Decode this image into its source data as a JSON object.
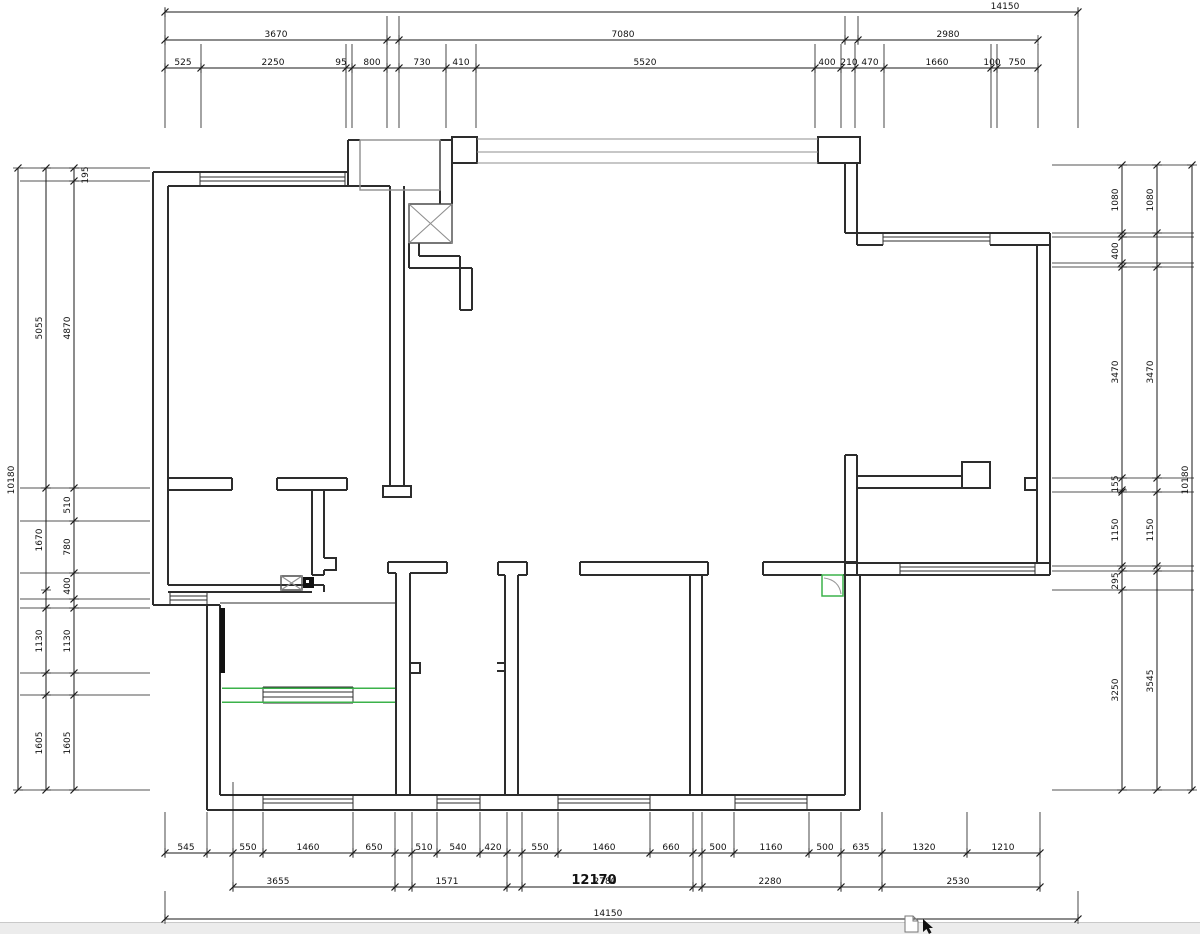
{
  "page": {
    "background": "#ffffff",
    "kind": "cad-floor-plan"
  },
  "colors": {
    "wall": "#2d2d2d",
    "dim_line": "#1a1a1a",
    "text": "#111111",
    "gray": "#8f8f8f",
    "green": "#3bb24a",
    "statusbar_bg": "#ececec"
  },
  "dim_rows": [
    {
      "name": "top-overall",
      "y": 12,
      "x1": 165,
      "x2": 1078,
      "ticks": [
        165,
        1078
      ],
      "labels": [
        {
          "t": "14150",
          "x": 1005
        }
      ]
    },
    {
      "name": "top-groups",
      "y": 40,
      "x1": 165,
      "x2": 1038,
      "ticks": [
        165,
        387,
        399,
        845,
        858,
        1038
      ],
      "labels": [
        {
          "t": "3670",
          "x": 276
        },
        {
          "t": "7080",
          "x": 623
        },
        {
          "t": "2980",
          "x": 948
        }
      ]
    },
    {
      "name": "top-detail",
      "y": 68,
      "x1": 165,
      "x2": 1038,
      "ticks": [
        165,
        201,
        346,
        352,
        387,
        399,
        446,
        476,
        815,
        841,
        855,
        884,
        991,
        997,
        1038
      ],
      "labels": [
        {
          "t": "525",
          "x": 183
        },
        {
          "t": "2250",
          "x": 273
        },
        {
          "t": "95",
          "x": 341
        },
        {
          "t": "800",
          "x": 372
        },
        {
          "t": "730",
          "x": 422
        },
        {
          "t": "410",
          "x": 461
        },
        {
          "t": "5520",
          "x": 645
        },
        {
          "t": "400",
          "x": 827
        },
        {
          "t": "210",
          "x": 849
        },
        {
          "t": "470",
          "x": 870
        },
        {
          "t": "1660",
          "x": 937
        },
        {
          "t": "100",
          "x": 992
        },
        {
          "t": "750",
          "x": 1017
        }
      ]
    },
    {
      "name": "bottom-detail",
      "y": 853,
      "x1": 165,
      "x2": 1040,
      "ticks": [
        165,
        207,
        233,
        263,
        353,
        395,
        412,
        437,
        480,
        507,
        522,
        558,
        650,
        693,
        702,
        734,
        809,
        841,
        882,
        967,
        1040
      ],
      "labels": [
        {
          "t": "545",
          "x": 186
        },
        {
          "t": "550",
          "x": 248
        },
        {
          "t": "1460",
          "x": 308
        },
        {
          "t": "650",
          "x": 374
        },
        {
          "t": "510",
          "x": 424
        },
        {
          "t": "540",
          "x": 458
        },
        {
          "t": "420",
          "x": 493
        },
        {
          "t": "550",
          "x": 540
        },
        {
          "t": "1460",
          "x": 604
        },
        {
          "t": "660",
          "x": 671
        },
        {
          "t": "500",
          "x": 718
        },
        {
          "t": "1160",
          "x": 771
        },
        {
          "t": "500",
          "x": 825
        },
        {
          "t": "635",
          "x": 861
        },
        {
          "t": "1320",
          "x": 924
        },
        {
          "t": "1210",
          "x": 1003
        }
      ]
    },
    {
      "name": "bottom-groups",
      "y": 887,
      "x1": 233,
      "x2": 1040,
      "ticks": [
        233,
        395,
        412,
        507,
        522,
        693,
        702,
        841,
        882,
        1040
      ],
      "labels": [
        {
          "t": "3655",
          "x": 278
        },
        {
          "t": "1571",
          "x": 447
        },
        {
          "t": "2780",
          "x": 605
        },
        {
          "t": "2280",
          "x": 770
        },
        {
          "t": "2530",
          "x": 958
        }
      ]
    },
    {
      "name": "bottom-overall",
      "y": 919,
      "x1": 165,
      "x2": 1078,
      "ticks": [
        165,
        1078
      ],
      "labels": [
        {
          "t": "14150",
          "x": 608
        }
      ]
    }
  ],
  "dim_cols": [
    {
      "name": "left-outer",
      "x": 18,
      "y1": 168,
      "y2": 790,
      "ticks": [
        168,
        790
      ],
      "labels": [
        {
          "t": "10180",
          "y": 480
        }
      ]
    },
    {
      "name": "left-mid",
      "x": 46,
      "y1": 168,
      "y2": 790,
      "ticks": [
        168,
        488,
        590,
        608,
        673,
        695,
        790
      ],
      "labels": [
        {
          "t": "5055",
          "y": 328
        },
        {
          "t": "1670",
          "y": 540
        },
        {
          "t": "1130",
          "y": 641
        },
        {
          "t": "1605",
          "y": 743
        }
      ]
    },
    {
      "name": "left-inner",
      "x": 74,
      "y1": 168,
      "y2": 790,
      "ticks": [
        168,
        181,
        488,
        521,
        573,
        599,
        608,
        673,
        695,
        790
      ],
      "labels": [
        {
          "t": "195",
          "y": 175,
          "dx": 14
        },
        {
          "t": "4870",
          "y": 328
        },
        {
          "t": "510",
          "y": 505
        },
        {
          "t": "780",
          "y": 547
        },
        {
          "t": "400",
          "y": 586
        },
        {
          "t": "1130",
          "y": 641
        },
        {
          "t": "1605",
          "y": 743
        }
      ]
    },
    {
      "name": "right-inner",
      "x": 1122,
      "y1": 165,
      "y2": 790,
      "ticks": [
        165,
        233,
        237,
        263,
        267,
        478,
        490,
        492,
        566,
        571,
        590,
        790
      ],
      "labels": [
        {
          "t": "1080",
          "y": 200
        },
        {
          "t": "400",
          "y": 251
        },
        {
          "t": "3470",
          "y": 372
        },
        {
          "t": "155",
          "y": 484
        },
        {
          "t": "1150",
          "y": 530
        },
        {
          "t": "295",
          "y": 581
        },
        {
          "t": "3250",
          "y": 690
        }
      ]
    },
    {
      "name": "right-mid",
      "x": 1157,
      "y1": 165,
      "y2": 790,
      "ticks": [
        165,
        233,
        267,
        478,
        492,
        566,
        571,
        790
      ],
      "labels": [
        {
          "t": "1080",
          "y": 200
        },
        {
          "t": "3470",
          "y": 372
        },
        {
          "t": "1150",
          "y": 530
        },
        {
          "t": "3545",
          "y": 681
        }
      ]
    },
    {
      "name": "right-outer",
      "x": 1192,
      "y1": 165,
      "y2": 790,
      "ticks": [
        165,
        790
      ],
      "labels": [
        {
          "t": "10180",
          "y": 480
        }
      ]
    }
  ],
  "ext_lines": {
    "vertical": [
      {
        "y1": 8,
        "y2": 128,
        "xs": [
          165,
          1078
        ]
      },
      {
        "y1": 16,
        "y2": 44,
        "xs": [
          387,
          399,
          845,
          858
        ]
      },
      {
        "y1": 44,
        "y2": 128,
        "xs": [
          201,
          346,
          352,
          387,
          399,
          446,
          476,
          815,
          841,
          855,
          884,
          991,
          997,
          1038
        ]
      },
      {
        "y1": 812,
        "y2": 857,
        "xs": [
          165,
          207,
          233,
          263,
          353,
          395,
          412,
          437,
          480,
          507,
          522,
          558,
          650,
          693,
          702,
          734,
          809,
          841,
          882,
          967,
          1040
        ]
      },
      {
        "y1": 857,
        "y2": 891,
        "xs": [
          233,
          395,
          412,
          507,
          522,
          693,
          702,
          841,
          882,
          1040
        ]
      },
      {
        "y1": 891,
        "y2": 921,
        "xs": [
          165,
          1078
        ]
      },
      {
        "y1": 782,
        "y2": 812,
        "xs": [
          233
        ]
      }
    ],
    "horizontal": [
      {
        "x1": 20,
        "x2": 150,
        "ys": [
          168,
          181,
          488,
          521,
          573,
          599,
          608,
          673,
          695,
          790
        ]
      },
      {
        "x1": 1052,
        "x2": 1194,
        "ys": [
          165,
          233,
          237,
          263,
          267,
          478,
          492,
          566,
          571,
          590,
          790
        ]
      }
    ]
  },
  "annotations": [
    {
      "t": "12170",
      "x": 594,
      "y": 884,
      "bold": true,
      "size": 13
    }
  ],
  "status_bar": {
    "scrollbar": true,
    "icons": [
      "page-icon",
      "cursor-icon"
    ]
  }
}
